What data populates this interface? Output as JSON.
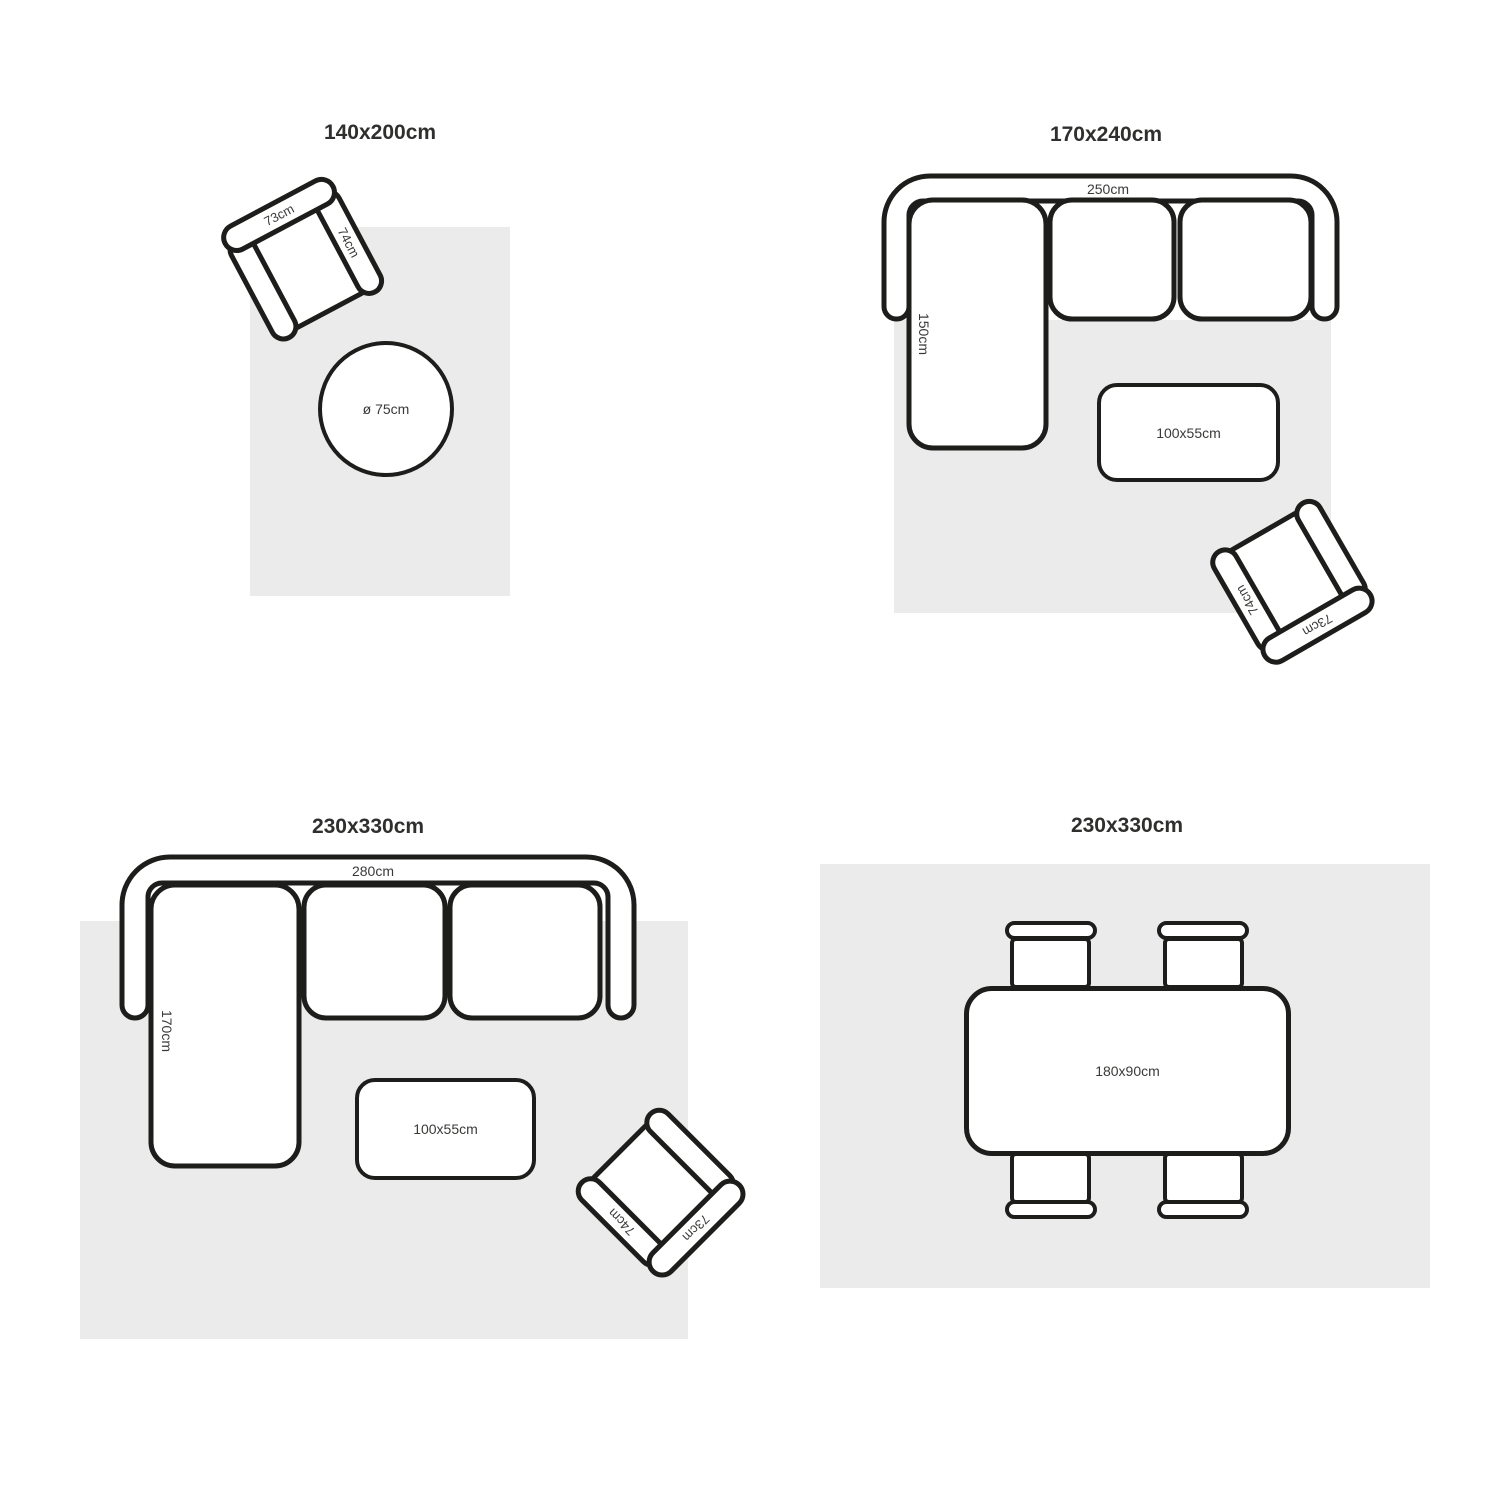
{
  "colors": {
    "background": "#ffffff",
    "rug": "#ebebeb",
    "outline": "#1d1d1b",
    "text": "#3a3a38",
    "title_text": "#2f2f2e"
  },
  "panels": [
    {
      "id": "rug-140x200",
      "title": "140x200cm",
      "furniture": {
        "armchair": {
          "back_label": "73cm",
          "arm_label": "74cm"
        },
        "round_table": {
          "label": "ø 75cm"
        }
      }
    },
    {
      "id": "rug-170x240",
      "title": "170x240cm",
      "furniture": {
        "sofa": {
          "width_label": "250cm",
          "chaise_label": "150cm"
        },
        "coffee_table": {
          "label": "100x55cm"
        },
        "armchair": {
          "back_label": "73cm",
          "arm_label": "74cm"
        }
      }
    },
    {
      "id": "rug-230x330-living",
      "title": "230x330cm",
      "furniture": {
        "sofa": {
          "width_label": "280cm",
          "chaise_label": "170cm"
        },
        "coffee_table": {
          "label": "100x55cm"
        },
        "armchair": {
          "back_label": "73cm",
          "arm_label": "74cm"
        }
      }
    },
    {
      "id": "rug-230x330-dining",
      "title": "230x330cm",
      "furniture": {
        "dining_table": {
          "label": "180x90cm"
        }
      }
    }
  ]
}
